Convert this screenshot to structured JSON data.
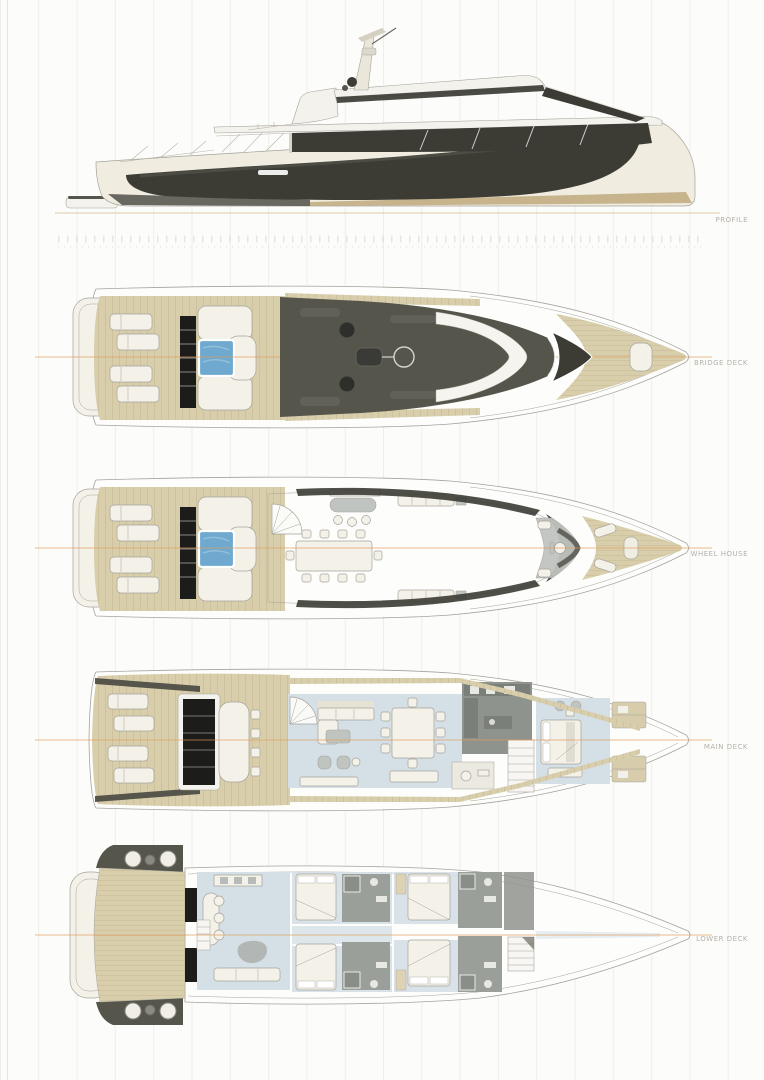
{
  "views": [
    {
      "id": "profile",
      "label": "PROFILE"
    },
    {
      "id": "bridge-deck",
      "label": "BRIDGE DECK"
    },
    {
      "id": "wheel-house",
      "label": "WHEEL HOUSE"
    },
    {
      "id": "main-deck",
      "label": "MAIN DECK"
    },
    {
      "id": "lower-deck",
      "label": "LOWER DECK"
    }
  ],
  "colors": {
    "hull_cream": "#f0ecdf",
    "superstructure_white": "#f4f2ec",
    "dark_glass": "#3c3c35",
    "hardtop_gray": "#55554c",
    "mid_gray": "#6b6b62",
    "black_glass": "#1c1c1a",
    "teak_deck": "#d8ceac",
    "teak_line": "#c2b58c",
    "pool_blue": "#6fa9cf",
    "floor_blue": "#d4dfe6",
    "furniture_white": "#f3f1e8",
    "furniture_gray": "#c0c4c0",
    "galley_gray": "#8f938d",
    "bath_gray": "#9aa099",
    "outline_gray": "#a5a39b",
    "centerline_orange": "#e19a55",
    "waterline_tan": "#d9c7a0",
    "boot_stripe": "#bfa97e",
    "label_gray": "#b5b1a9",
    "grid_line": "#efeeea"
  }
}
